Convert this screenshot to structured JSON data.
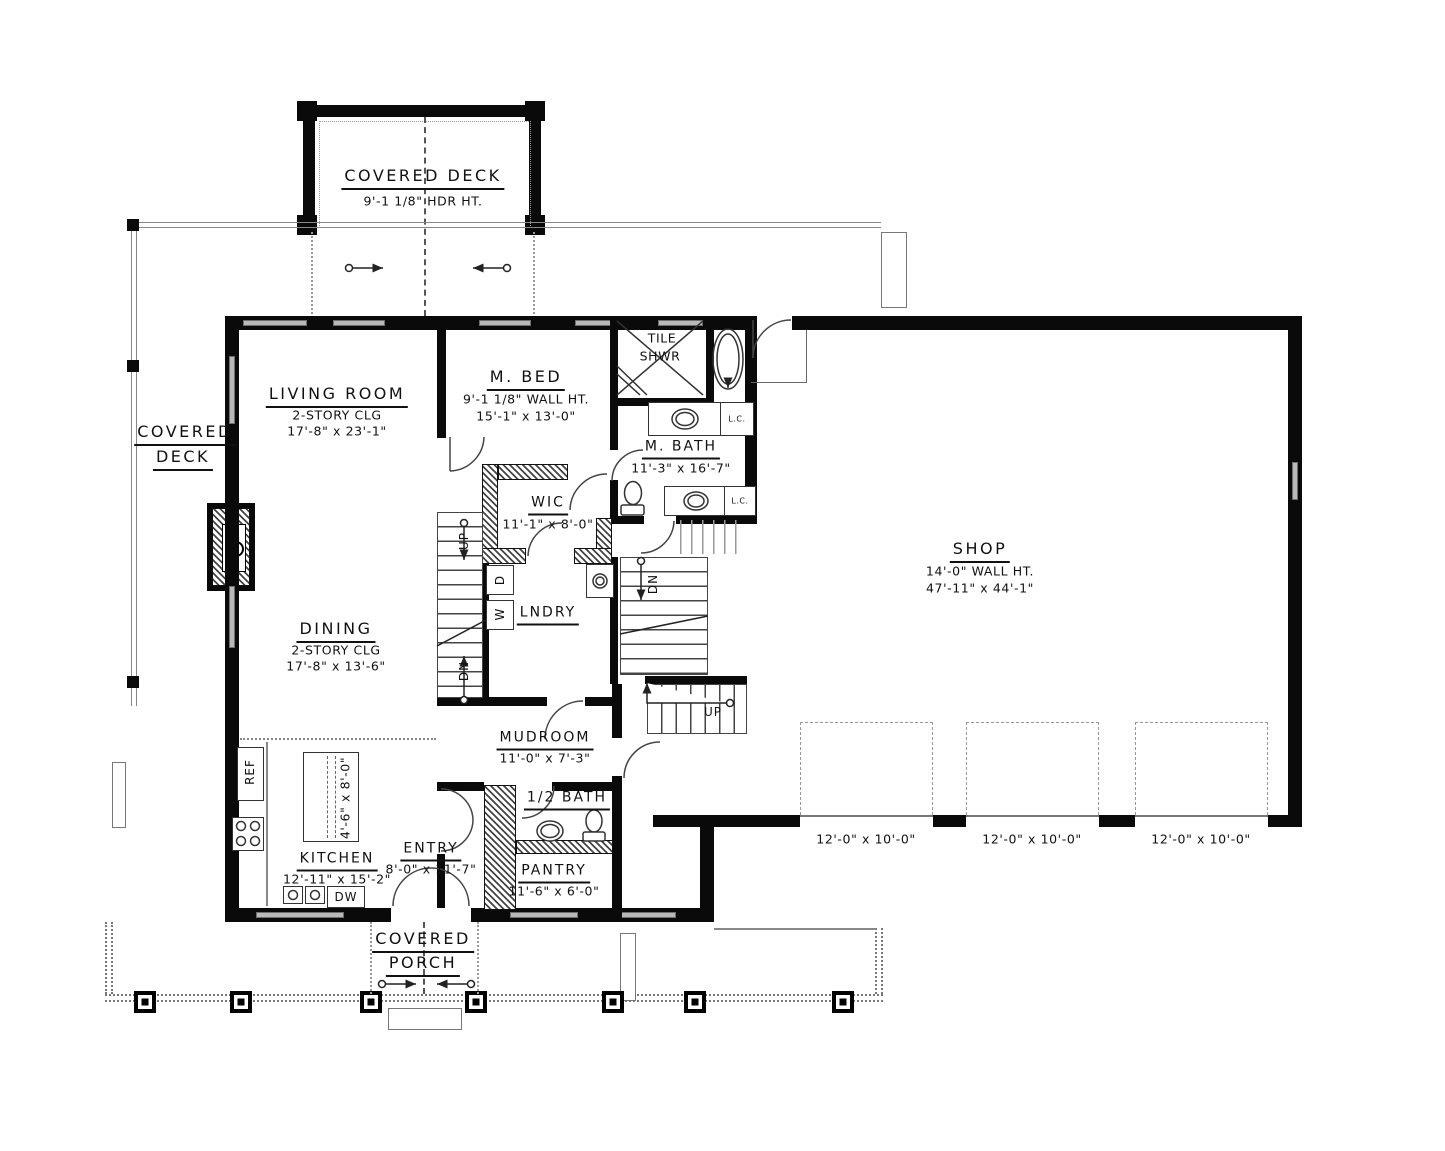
{
  "drawing": {
    "rooms": {
      "covered_deck_top": {
        "name": "COVERED DECK",
        "note": "9'-1 1/8\" HDR HT."
      },
      "covered_deck_left": {
        "line1": "COVERED",
        "line2": "DECK"
      },
      "living_room": {
        "name": "LIVING ROOM",
        "note": "2-STORY CLG",
        "dims": "17'-8\" x 23'-1\""
      },
      "m_bed": {
        "name": "M. BED",
        "note": "9'-1 1/8\" WALL HT.",
        "dims": "15'-1\" x 13'-0\""
      },
      "tile_shower": {
        "line1": "TILE",
        "line2": "SHWR"
      },
      "m_bath": {
        "name": "M. BATH",
        "dims": "11'-3\" x 16'-7\""
      },
      "wic": {
        "name": "WIC",
        "dims": "11'-1\" x 8'-0\""
      },
      "laundry": {
        "name": "LNDRY"
      },
      "shop": {
        "name": "SHOP",
        "note": "14'-0\" WALL HT.",
        "dims": "47'-11\" x 44'-1\""
      },
      "dining": {
        "name": "DINING",
        "note": "2-STORY CLG",
        "dims": "17'-8\" x 13'-6\""
      },
      "mudroom": {
        "name": "MUDROOM",
        "dims": "11'-0\" x 7'-3\""
      },
      "kitchen": {
        "name": "KITCHEN",
        "dims": "12'-11\" x 15'-2\""
      },
      "entry": {
        "name": "ENTRY",
        "dims": "8'-0\" x 11'-7\""
      },
      "half_bath": {
        "name": "1/2 BATH"
      },
      "pantry": {
        "name": "PANTRY",
        "dims": "11'-6\" x 6'-0\""
      },
      "covered_porch": {
        "line1": "COVERED",
        "line2": "PORCH"
      }
    },
    "fixtures": {
      "island_dims": "4'-6\" x 8'-0\"",
      "ref": "REF",
      "dw": "DW",
      "washer": "W",
      "dryer": "D",
      "lc": "L.C."
    },
    "stairs": {
      "up": "UP",
      "dn": "DN"
    },
    "garage_doors": [
      "12'-0\" x 10'-0\"",
      "12'-0\" x 10'-0\"",
      "12'-0\" x 10'-0\""
    ]
  }
}
